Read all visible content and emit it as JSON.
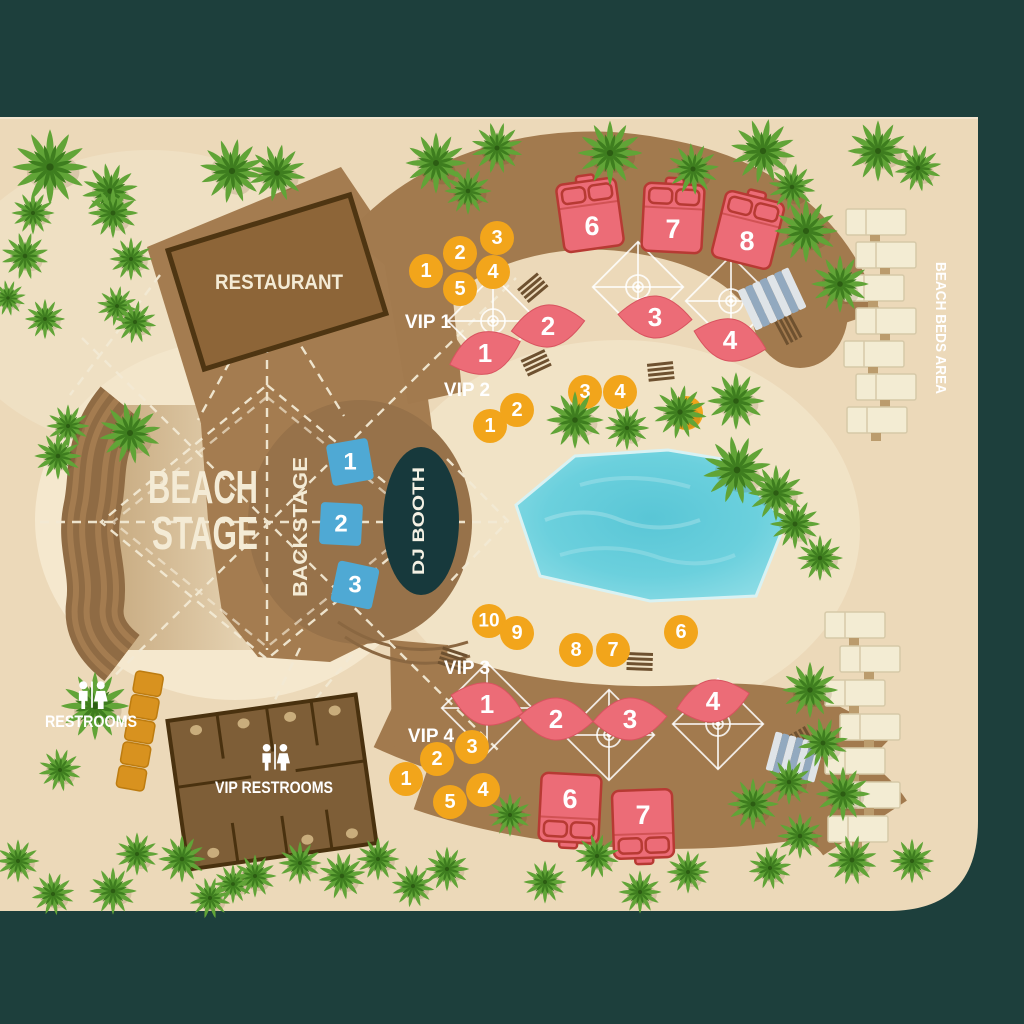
{
  "labels": {
    "restaurant": "RESTAURANT",
    "beach_stage_line1": "BEACH",
    "beach_stage_line2": "STAGE",
    "backstage": "BACKSTAGE",
    "dj_booth": "DJ BOOTH",
    "restrooms": "RESTROOMS",
    "vip_restrooms": "VIP RESTROOMS",
    "beach_beds_area": "BEACH BEDS AREA",
    "vip1": "VIP 1",
    "vip2": "VIP 2",
    "vip3": "VIP 3",
    "vip4": "VIP 4"
  },
  "tables": {
    "backstage": [
      "1",
      "2",
      "3"
    ],
    "vip1": [
      "1",
      "2",
      "3",
      "4",
      "5"
    ],
    "vip2": [
      "1",
      "2",
      "3",
      "4",
      "5"
    ],
    "vip3": [
      "10",
      "9",
      "8",
      "7",
      "6"
    ],
    "vip4": [
      "1",
      "2",
      "3",
      "4",
      "5"
    ]
  },
  "daybeds": {
    "upper": [
      "1",
      "2",
      "3",
      "4"
    ],
    "lower": [
      "1",
      "2",
      "3",
      "4"
    ]
  },
  "beds": {
    "upper": [
      "6",
      "7",
      "8"
    ],
    "lower": [
      "6",
      "7"
    ]
  },
  "colors": {
    "frame_teal": "#1d3f3c",
    "sand": "#ecd9b9",
    "sand_light": "#f5e8ce",
    "deck_brown": "#a47c50",
    "deck_dark": "#8a6741",
    "building_brown": "#8d6538",
    "building_border": "#4e3512",
    "pool_blue": "#5fc9d8",
    "table_yellow": "#f2a51b",
    "bed_pink": "#ec6c77",
    "bed_border": "#b73a33",
    "backstage_blue": "#4fa9d4",
    "booth_dark": "#17393c",
    "bar_orange": "#d8921f",
    "palm_green": "#61a437",
    "text_cream": "#f3e9d2"
  }
}
